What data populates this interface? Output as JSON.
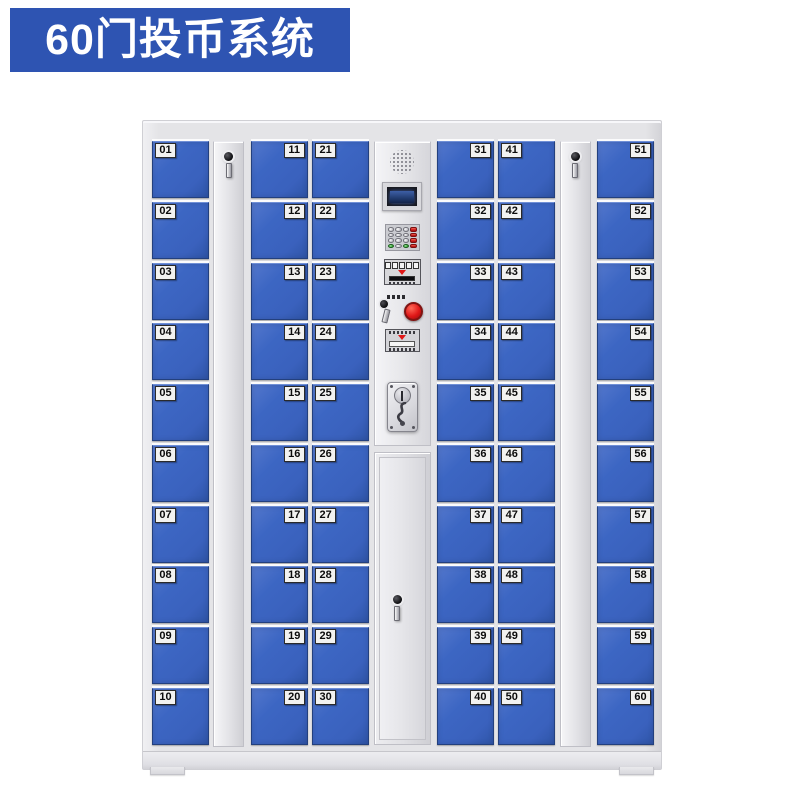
{
  "title_badge": {
    "label": "60门投币系统"
  },
  "colors": {
    "badge_blue": "#2e54b2",
    "door_blue": "#3c66c3",
    "frame_gray": "#e4e4e7",
    "button_red": "#e01818",
    "key_red": "#d42020",
    "key_green": "#3fae3f"
  },
  "cabinet": {
    "columns": [
      {
        "type": "doors",
        "name": "door-column-1",
        "label_side": "left",
        "doors": [
          "01",
          "02",
          "03",
          "04",
          "05",
          "06",
          "07",
          "08",
          "09",
          "10"
        ]
      },
      {
        "type": "panel",
        "name": "left-lock-panel"
      },
      {
        "type": "doors",
        "name": "door-column-2",
        "label_side": "right",
        "doors": [
          "11",
          "12",
          "13",
          "14",
          "15",
          "16",
          "17",
          "18",
          "19",
          "20"
        ]
      },
      {
        "type": "doors",
        "name": "door-column-3",
        "label_side": "left",
        "doors": [
          "21",
          "22",
          "23",
          "24",
          "25",
          "26",
          "27",
          "28",
          "29",
          "30"
        ]
      },
      {
        "type": "control",
        "name": "control-column"
      },
      {
        "type": "doors",
        "name": "door-column-4",
        "label_side": "right",
        "doors": [
          "31",
          "32",
          "33",
          "34",
          "35",
          "36",
          "37",
          "38",
          "39",
          "40"
        ]
      },
      {
        "type": "doors",
        "name": "door-column-5",
        "label_side": "left",
        "doors": [
          "41",
          "42",
          "43",
          "44",
          "45",
          "46",
          "47",
          "48",
          "49",
          "50"
        ]
      },
      {
        "type": "panel",
        "name": "right-lock-panel"
      },
      {
        "type": "doors",
        "name": "door-column-6",
        "label_side": "right",
        "doors": [
          "51",
          "52",
          "53",
          "54",
          "55",
          "56",
          "57",
          "58",
          "59",
          "60"
        ]
      }
    ]
  }
}
